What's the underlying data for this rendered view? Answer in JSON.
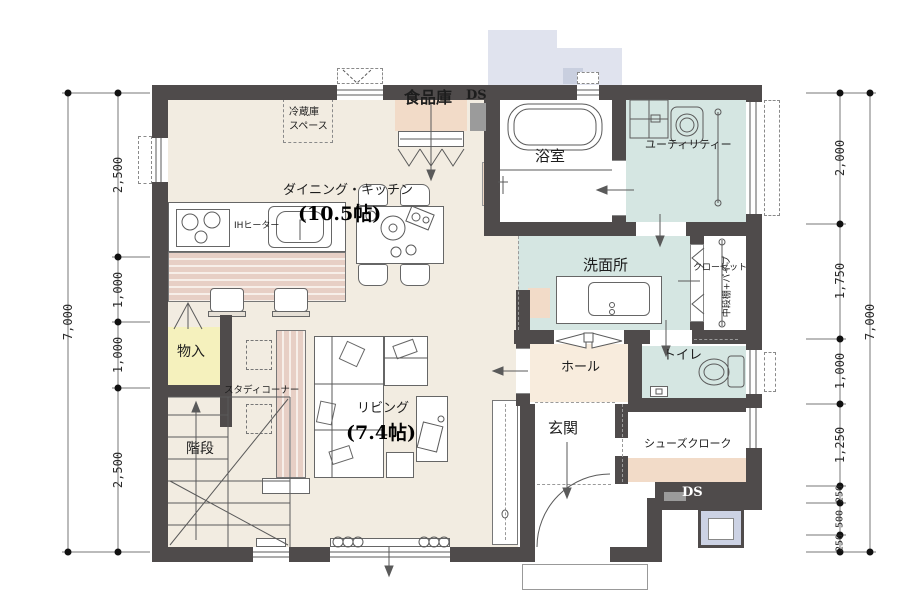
{
  "rooms": {
    "dining_kitchen": {
      "label": "ダイニング・キッチン",
      "size": "(10.5帖)"
    },
    "living": {
      "label": "リビング",
      "size": "(7.4帖)"
    },
    "pantry": {
      "label": "食品庫"
    },
    "fridge_space": {
      "line1": "冷蔵庫",
      "line2": "スペース"
    },
    "kitchen": {
      "stove_label": "IHヒーター"
    },
    "bath": {
      "label": "浴室"
    },
    "utility": {
      "label": "ユーティリティー"
    },
    "washroom": {
      "label": "洗面所"
    },
    "closet": {
      "label": "クローゼット",
      "shelf_note": "中段棚+パイプ"
    },
    "toilet": {
      "label": "トイレ"
    },
    "hall": {
      "label": "ホール"
    },
    "entrance": {
      "label": "玄関"
    },
    "shoe_closet": {
      "label": "シューズクローク"
    },
    "storage": {
      "label": "物入"
    },
    "study_corner": {
      "label": "スタディコーナー"
    },
    "stairs": {
      "label": "階段"
    }
  },
  "ducts": {
    "top_label": "DS",
    "bottom_label": "DS"
  },
  "dimensions": {
    "left": {
      "total": "7,000",
      "segments": [
        "2,500",
        "1,000",
        "1,000",
        "2,500"
      ]
    },
    "right": {
      "total": "7,000",
      "segments": [
        "2,000",
        "1,750",
        "1,000",
        "1,250",
        "250",
        "500",
        "250"
      ]
    }
  },
  "colors": {
    "wall": "#4f4b4b",
    "floor": "#f2ece1",
    "wet_floor": "#d5e6e2",
    "hall_floor": "#f8ecdd",
    "closet_peach": "#f2dbc8",
    "storage_yellow": "#f5f1bd",
    "counter_stripe": "#e7cfc5",
    "canopy": "#e0e3ee",
    "duct_gray": "#9b9b9b"
  }
}
